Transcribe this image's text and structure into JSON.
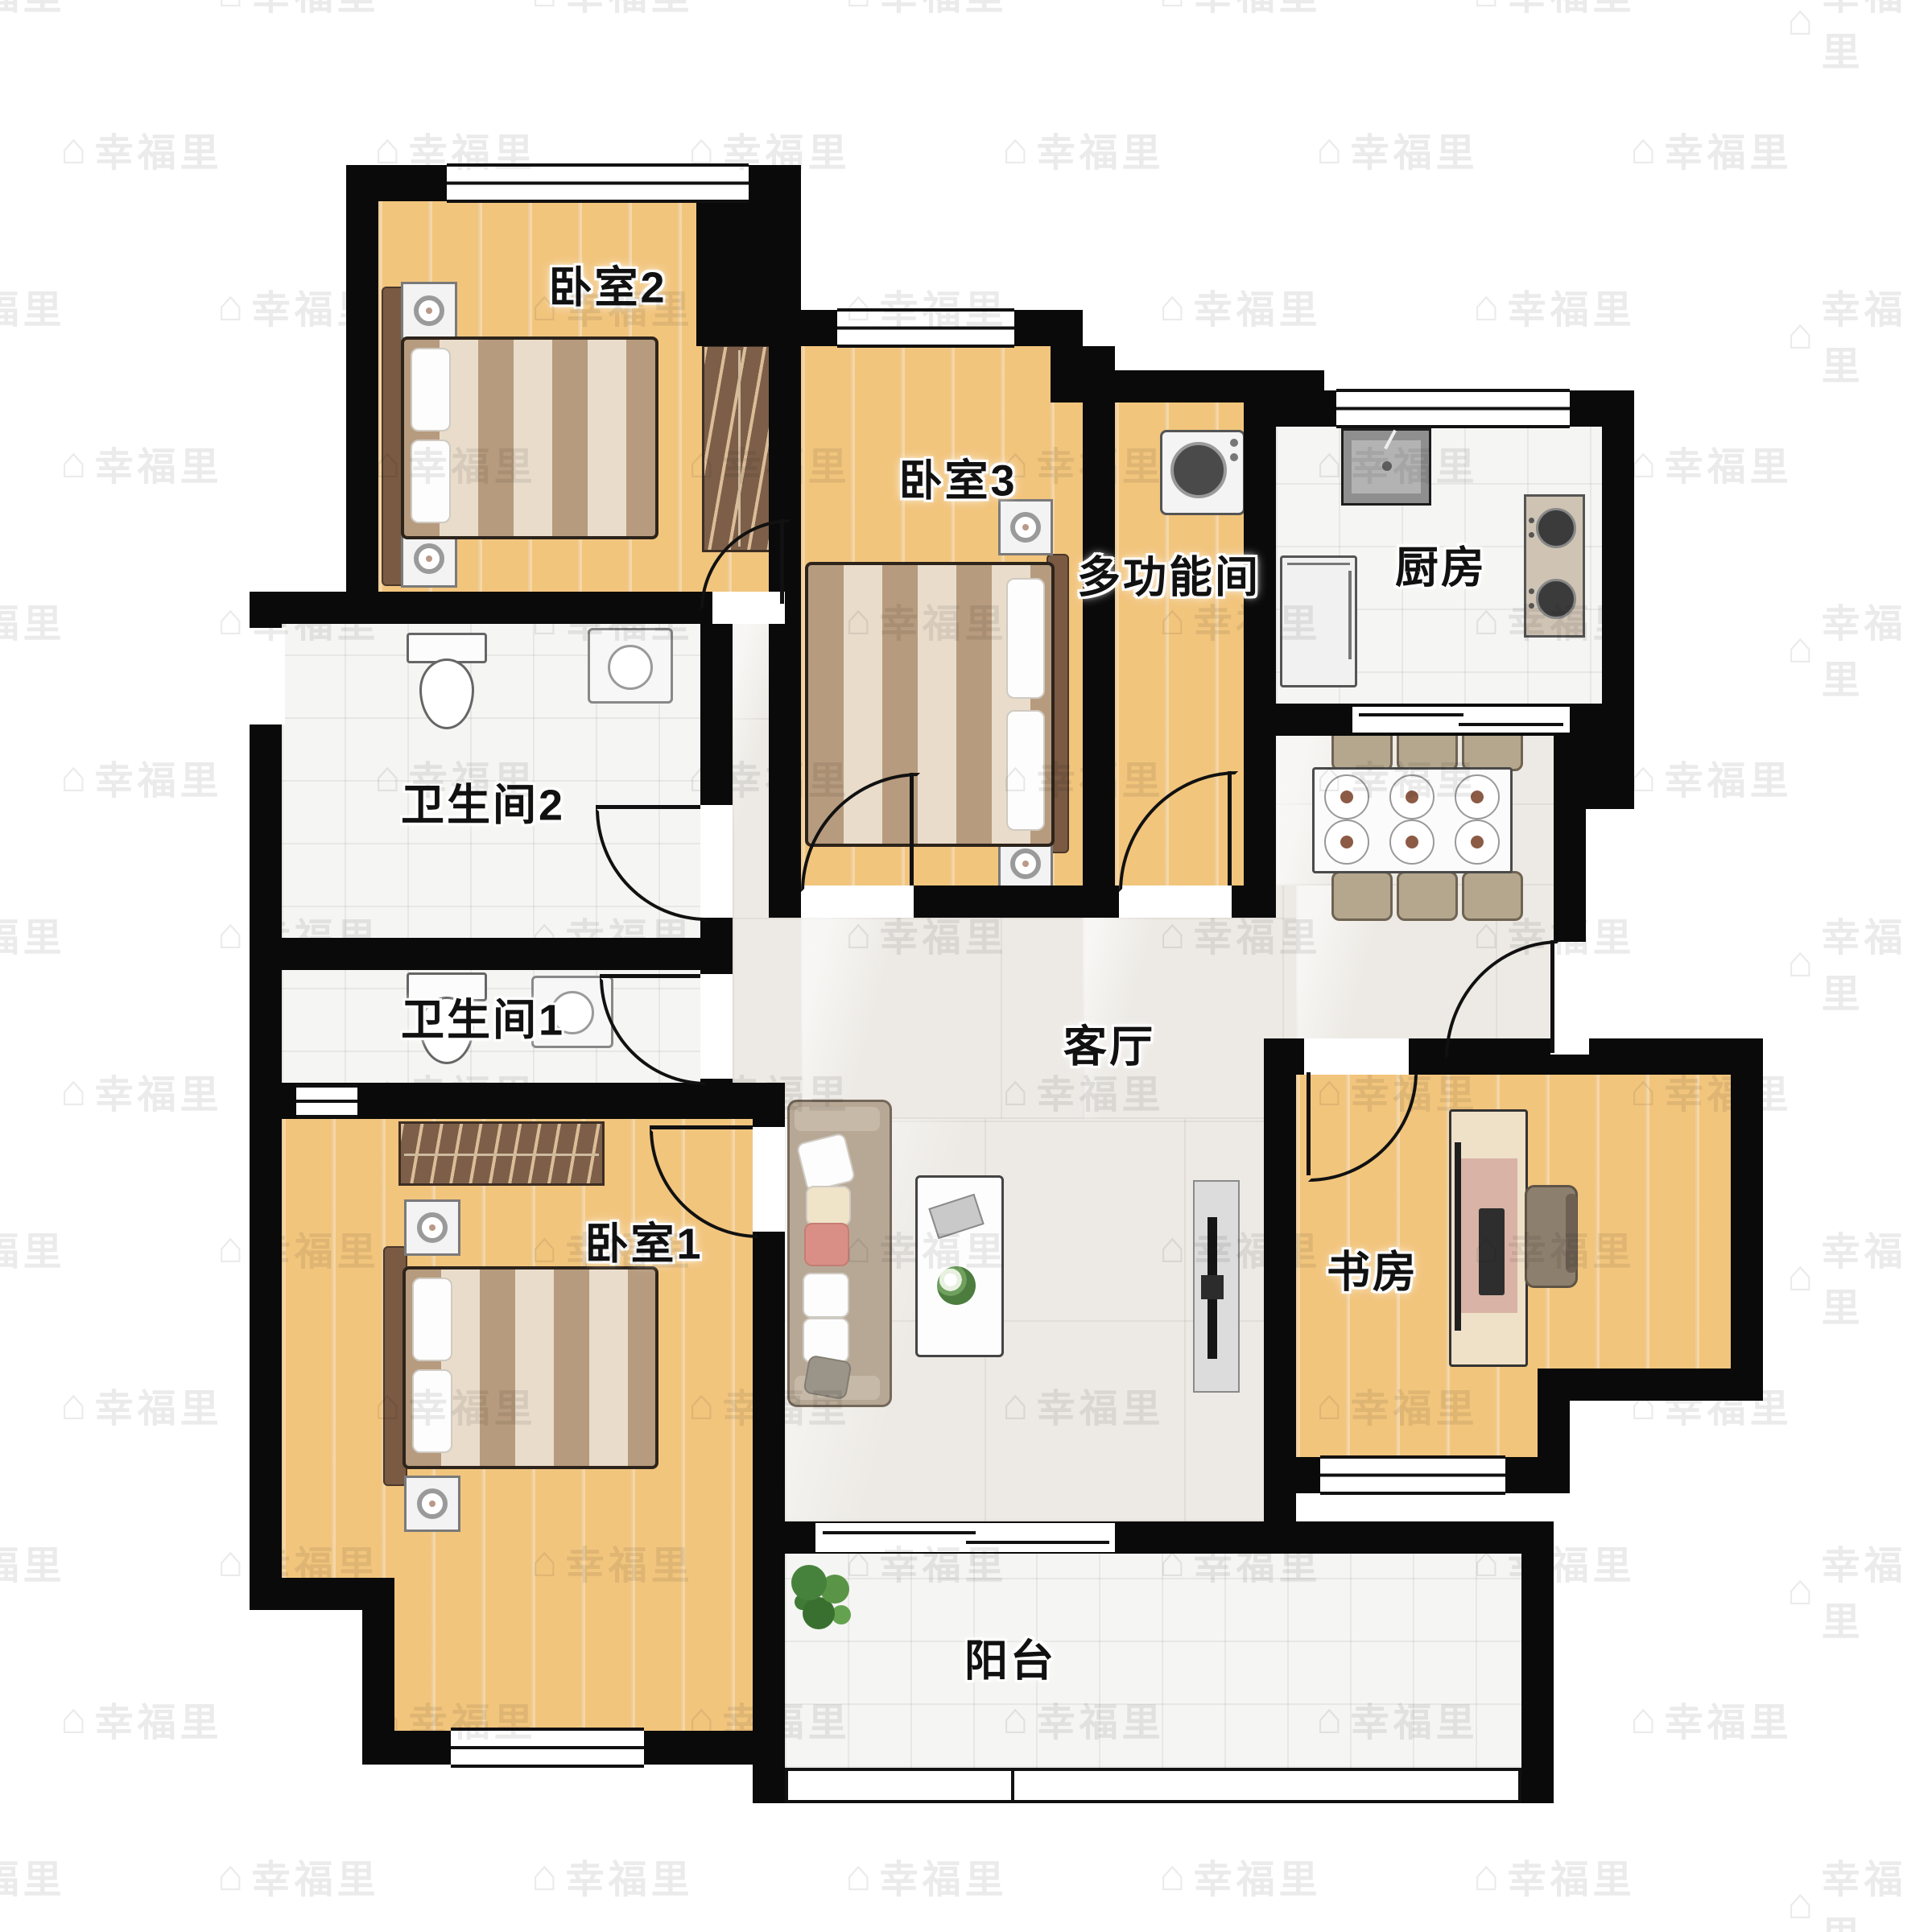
{
  "watermark": {
    "text": "幸福里",
    "icon": "house-icon"
  },
  "rooms": {
    "bedroom2": {
      "label": "卧室2"
    },
    "bedroom3": {
      "label": "卧室3"
    },
    "multi": {
      "label": "多功能间"
    },
    "kitchen": {
      "label": "厨房"
    },
    "bath2": {
      "label": "卫生间2"
    },
    "bath1": {
      "label": "卫生间1"
    },
    "bedroom1": {
      "label": "卧室1"
    },
    "living": {
      "label": "客厅"
    },
    "study": {
      "label": "书房"
    },
    "balcony": {
      "label": "阳台"
    }
  },
  "furniture_icons": [
    "double-bed-icon",
    "nightstand-lamp-icon",
    "wardrobe-icon",
    "toilet-icon",
    "washbasin-icon",
    "washing-machine-icon",
    "kitchen-sink-icon",
    "gas-stove-icon",
    "fridge-icon",
    "dining-table-6-seats-icon",
    "sofa-icon",
    "coffee-table-icon",
    "tv-cabinet-icon",
    "desk-computer-icon",
    "office-chair-icon",
    "potted-plant-icon"
  ],
  "colors": {
    "wall": "#0a0a0a",
    "wood_floor": "#f2c57d",
    "marble_floor": "#edeae5",
    "tile_floor": "#f5f5f3",
    "label_text": "#111111",
    "label_halo": "#ffffff",
    "watermark": "rgba(70,70,70,0.10)"
  }
}
